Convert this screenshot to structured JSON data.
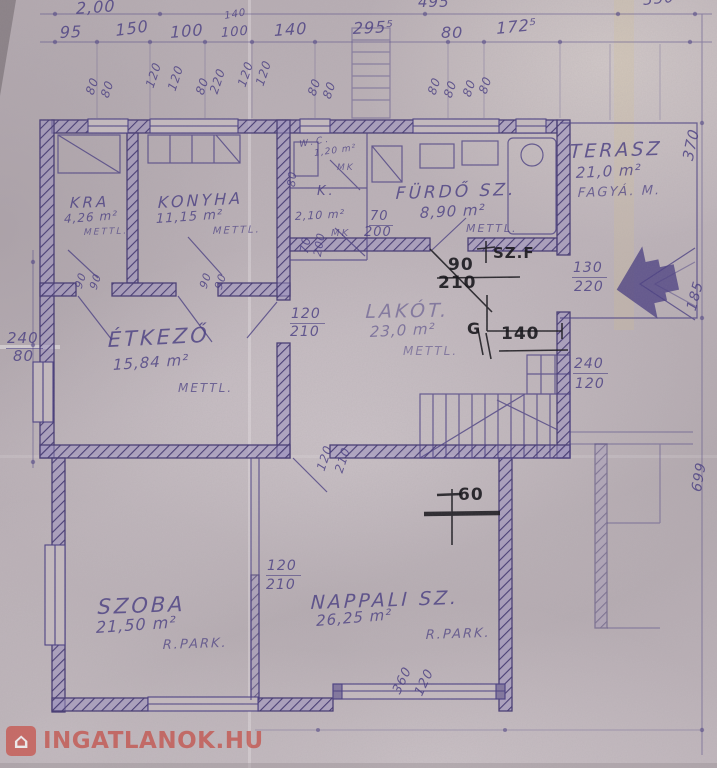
{
  "watermark": {
    "text": "INGATLANOK.HU",
    "icon": "house-icon",
    "color": "#c4483f"
  },
  "plan_colors": {
    "blueprint_line": "#4a3f82",
    "ink_annotation": "#17161b",
    "paper": "#b8aeb4"
  },
  "labels": [
    {
      "n": "room-label-kra",
      "t": "KRA",
      "x": 70,
      "y": 196,
      "s": 15,
      "r": -2,
      "c": "room"
    },
    {
      "n": "room-area-kra",
      "t": "4,26 m²",
      "x": 64,
      "y": 213,
      "s": 12,
      "r": -4,
      "c": "area"
    },
    {
      "n": "room-note-kra",
      "t": "METTL.",
      "x": 84,
      "y": 229,
      "s": 9,
      "r": -2,
      "c": "note"
    },
    {
      "n": "room-label-konyha",
      "t": "KONYHA",
      "x": 158,
      "y": 195,
      "s": 16,
      "r": -3,
      "c": "room"
    },
    {
      "n": "room-area-konyha",
      "t": "11,15 m²",
      "x": 156,
      "y": 213,
      "s": 13,
      "r": -4,
      "c": "area"
    },
    {
      "n": "room-note-konyha",
      "t": "METTL.",
      "x": 213,
      "y": 227,
      "s": 10,
      "r": -2,
      "c": "note"
    },
    {
      "n": "room-label-wc",
      "t": "W.C.",
      "x": 299,
      "y": 141,
      "s": 9,
      "r": -10,
      "c": "room"
    },
    {
      "n": "room-area-wc",
      "t": "1,20 m²",
      "x": 314,
      "y": 150,
      "s": 9,
      "r": -8,
      "c": "area"
    },
    {
      "n": "room-note-wc",
      "t": "MK",
      "x": 337,
      "y": 164,
      "s": 9,
      "r": 0,
      "c": "note"
    },
    {
      "n": "room-label-k",
      "t": "K.",
      "x": 317,
      "y": 185,
      "s": 13,
      "r": 0,
      "c": "room"
    },
    {
      "n": "room-area-k",
      "t": "2,10 m²",
      "x": 295,
      "y": 211,
      "s": 11,
      "r": -3,
      "c": "area"
    },
    {
      "n": "room-note-k",
      "t": "MK",
      "x": 331,
      "y": 229,
      "s": 10,
      "r": 0,
      "c": "note"
    },
    {
      "n": "room-label-furdo",
      "t": "FÜRDŐ SZ.",
      "x": 396,
      "y": 186,
      "s": 17,
      "r": -2,
      "c": "room"
    },
    {
      "n": "room-area-furdo",
      "t": "8,90 m²",
      "x": 420,
      "y": 206,
      "s": 15,
      "r": -3,
      "c": "area"
    },
    {
      "n": "room-note-furdo",
      "t": "METTL.",
      "x": 466,
      "y": 223,
      "s": 11,
      "r": 0,
      "c": "note"
    },
    {
      "n": "room-label-terasz",
      "t": "TERASZ",
      "x": 570,
      "y": 143,
      "s": 19,
      "r": -2,
      "c": "room"
    },
    {
      "n": "room-area-terasz",
      "t": "21,0 m²",
      "x": 576,
      "y": 166,
      "s": 15,
      "r": -3,
      "c": "area"
    },
    {
      "n": "room-note-terasz",
      "t": "FAGYÁ. M.",
      "x": 578,
      "y": 187,
      "s": 13,
      "r": -2,
      "c": "note"
    },
    {
      "n": "room-label-etkezo",
      "t": "ÉTKEZŐ",
      "x": 108,
      "y": 330,
      "s": 21,
      "r": -3,
      "c": "room"
    },
    {
      "n": "room-area-etkezo",
      "t": "15,84 m²",
      "x": 113,
      "y": 358,
      "s": 15,
      "r": -4,
      "c": "area"
    },
    {
      "n": "room-note-etkezo",
      "t": "METTL.",
      "x": 178,
      "y": 382,
      "s": 12,
      "r": 0,
      "c": "note"
    },
    {
      "n": "room-label-lakot",
      "t": "LAKÓT.",
      "x": 366,
      "y": 303,
      "s": 19,
      "r": -1,
      "c": "room",
      "o": 0.5
    },
    {
      "n": "room-area-lakot",
      "t": "23,0 m²",
      "x": 370,
      "y": 325,
      "s": 15,
      "r": -3,
      "c": "area",
      "o": 0.55
    },
    {
      "n": "room-note-lakot",
      "t": "METTL.",
      "x": 403,
      "y": 345,
      "s": 12,
      "r": 0,
      "c": "note",
      "o": 0.5
    },
    {
      "n": "room-label-szoba",
      "t": "SZOBA",
      "x": 98,
      "y": 597,
      "s": 21,
      "r": -2,
      "c": "room"
    },
    {
      "n": "room-area-szoba",
      "t": "21,50 m²",
      "x": 96,
      "y": 620,
      "s": 16,
      "r": -4,
      "c": "area"
    },
    {
      "n": "room-note-szoba",
      "t": "R.PARK.",
      "x": 163,
      "y": 639,
      "s": 13,
      "r": -2,
      "c": "note"
    },
    {
      "n": "room-label-nappali",
      "t": "NAPPALI SZ.",
      "x": 311,
      "y": 594,
      "s": 19,
      "r": -2,
      "c": "room"
    },
    {
      "n": "room-area-nappali",
      "t": "26,25 m²",
      "x": 316,
      "y": 614,
      "s": 15,
      "r": -5,
      "c": "area"
    },
    {
      "n": "room-note-nappali",
      "t": "R.PARK.",
      "x": 426,
      "y": 629,
      "s": 13,
      "r": -2,
      "c": "note"
    },
    {
      "t": "2,00",
      "x": 76,
      "y": 1,
      "s": 16,
      "r": -4,
      "c": "dim"
    },
    {
      "t": "495",
      "x": 418,
      "y": -5,
      "s": 15,
      "c": "dim"
    },
    {
      "t": "350",
      "x": 643,
      "y": -7,
      "s": 15,
      "r": -6,
      "c": "dim"
    },
    {
      "t": "95",
      "x": 60,
      "y": 25,
      "s": 16,
      "r": -3,
      "c": "dim"
    },
    {
      "t": "150",
      "x": 115,
      "y": 23,
      "s": 16,
      "r": -8,
      "c": "dim"
    },
    {
      "t": "100",
      "x": 170,
      "y": 25,
      "s": 16,
      "r": -5,
      "c": "dim"
    },
    {
      "t": "140",
      "x": 224,
      "y": 12,
      "s": 10,
      "r": -10,
      "c": "dim"
    },
    {
      "t": "100",
      "x": 221,
      "y": 27,
      "s": 13,
      "r": -5,
      "c": "dim"
    },
    {
      "t": "140",
      "x": 274,
      "y": 23,
      "s": 16,
      "r": -4,
      "c": "dim"
    },
    {
      "t": "295⁵",
      "x": 353,
      "y": 21,
      "s": 16,
      "r": -3,
      "c": "dim"
    },
    {
      "t": "80",
      "x": 441,
      "y": 25,
      "s": 16,
      "c": "dim"
    },
    {
      "t": "172⁵",
      "x": 496,
      "y": 21,
      "s": 16,
      "r": -6,
      "c": "dim"
    },
    {
      "t": "80",
      "x": 84,
      "y": 92,
      "s": 12,
      "r": -72,
      "c": "dim"
    },
    {
      "t": "80",
      "x": 99,
      "y": 95,
      "s": 12,
      "r": -72,
      "c": "dim"
    },
    {
      "t": "120",
      "x": 144,
      "y": 85,
      "s": 12,
      "r": -72,
      "c": "dim"
    },
    {
      "t": "120",
      "x": 166,
      "y": 88,
      "s": 12,
      "r": -72,
      "c": "dim"
    },
    {
      "t": "80",
      "x": 194,
      "y": 92,
      "s": 12,
      "r": -72,
      "c": "dim"
    },
    {
      "t": "220",
      "x": 208,
      "y": 91,
      "s": 12,
      "r": -72,
      "c": "dim"
    },
    {
      "t": "120",
      "x": 236,
      "y": 84,
      "s": 12,
      "r": -72,
      "c": "dim"
    },
    {
      "t": "120",
      "x": 254,
      "y": 83,
      "s": 12,
      "r": -72,
      "c": "dim"
    },
    {
      "t": "80",
      "x": 306,
      "y": 93,
      "s": 12,
      "r": -72,
      "c": "dim"
    },
    {
      "t": "80",
      "x": 321,
      "y": 96,
      "s": 12,
      "r": -72,
      "c": "dim"
    },
    {
      "t": "80",
      "x": 426,
      "y": 92,
      "s": 12,
      "r": -72,
      "c": "dim"
    },
    {
      "t": "80",
      "x": 442,
      "y": 95,
      "s": 12,
      "r": -72,
      "c": "dim"
    },
    {
      "t": "80",
      "x": 461,
      "y": 94,
      "s": 12,
      "r": -72,
      "c": "dim"
    },
    {
      "t": "80",
      "x": 477,
      "y": 91,
      "s": 12,
      "r": -72,
      "c": "dim"
    },
    {
      "t": "90",
      "x": 73,
      "y": 286,
      "s": 11,
      "r": -72,
      "c": "dim"
    },
    {
      "t": "90",
      "x": 88,
      "y": 287,
      "s": 11,
      "r": -72,
      "c": "dim"
    },
    {
      "t": "90",
      "x": 198,
      "y": 286,
      "s": 11,
      "r": -72,
      "c": "dim"
    },
    {
      "t": "90",
      "x": 213,
      "y": 287,
      "s": 11,
      "r": -72,
      "c": "dim"
    },
    {
      "t": "80",
      "x": 286,
      "y": 186,
      "s": 11,
      "r": -85,
      "c": "dim"
    },
    {
      "t": "70",
      "x": 298,
      "y": 252,
      "s": 12,
      "r": -80,
      "c": "dim"
    },
    {
      "t": "200",
      "x": 312,
      "y": 255,
      "s": 11,
      "r": -80,
      "c": "dim"
    },
    {
      "t": "120",
      "x": 315,
      "y": 468,
      "s": 12,
      "r": -72,
      "c": "dim"
    },
    {
      "t": "210",
      "x": 333,
      "y": 470,
      "s": 12,
      "r": -72,
      "c": "dim"
    },
    {
      "t": "360",
      "x": 391,
      "y": 690,
      "s": 13,
      "r": -65,
      "c": "dim"
    },
    {
      "t": "120",
      "x": 413,
      "y": 692,
      "s": 13,
      "r": -65,
      "c": "dim"
    },
    {
      "t": "370",
      "x": 681,
      "y": 158,
      "s": 15,
      "r": -78,
      "c": "dim"
    },
    {
      "t": "185",
      "x": 685,
      "y": 308,
      "s": 14,
      "r": -75,
      "c": "dim"
    },
    {
      "t": "699",
      "x": 690,
      "y": 490,
      "s": 14,
      "r": -80,
      "c": "dim"
    },
    {
      "t": "240",
      "x": 6,
      "y": 331,
      "s": 15,
      "c": "dim",
      "u": true
    },
    {
      "t": "80",
      "x": 13,
      "y": 349,
      "s": 15,
      "c": "dim"
    },
    {
      "t": "130",
      "x": 572,
      "y": 261,
      "s": 14,
      "c": "dim",
      "u": true
    },
    {
      "t": "220",
      "x": 574,
      "y": 280,
      "s": 14,
      "c": "dim"
    },
    {
      "t": "240",
      "x": 573,
      "y": 357,
      "s": 14,
      "c": "dim",
      "u": true
    },
    {
      "t": "120",
      "x": 575,
      "y": 377,
      "s": 14,
      "c": "dim"
    },
    {
      "t": "120",
      "x": 290,
      "y": 307,
      "s": 14,
      "c": "dim",
      "u": true
    },
    {
      "t": "210",
      "x": 290,
      "y": 325,
      "s": 14,
      "c": "dim"
    },
    {
      "t": "70",
      "x": 369,
      "y": 210,
      "s": 13,
      "c": "dim",
      "u": true
    },
    {
      "t": "200",
      "x": 364,
      "y": 226,
      "s": 13,
      "c": "dim"
    },
    {
      "t": "120",
      "x": 266,
      "y": 559,
      "s": 14,
      "c": "dim",
      "u": true
    },
    {
      "t": "210",
      "x": 266,
      "y": 578,
      "s": 14,
      "c": "dim"
    },
    {
      "n": "ink-note-szf",
      "t": "SZ.F",
      "x": 493,
      "y": 246,
      "s": 15,
      "c": "ink"
    },
    {
      "n": "ink-dim-90",
      "t": "90",
      "x": 448,
      "y": 257,
      "s": 17,
      "c": "ink"
    },
    {
      "n": "ink-dim-210",
      "t": "210",
      "x": 438,
      "y": 275,
      "s": 17,
      "c": "ink"
    },
    {
      "n": "ink-note-g",
      "t": "G",
      "x": 467,
      "y": 321,
      "s": 16,
      "c": "ink"
    },
    {
      "n": "ink-dim-140",
      "t": "140",
      "x": 501,
      "y": 326,
      "s": 17,
      "c": "ink"
    },
    {
      "n": "ink-dim-60",
      "t": "60",
      "x": 458,
      "y": 487,
      "s": 17,
      "c": "ink"
    }
  ]
}
